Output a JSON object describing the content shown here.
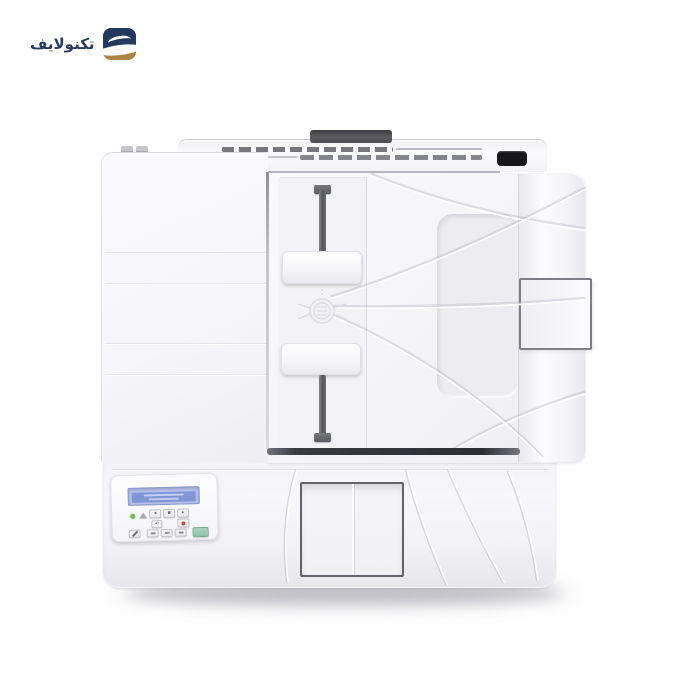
{
  "watermark": {
    "text": "تكنولايف",
    "colors": {
      "navy": "#223a5e",
      "gold": "#ab8444",
      "swoosh": "#ffffff"
    }
  },
  "product_photo": {
    "subject": "white multifunction laser printer, top view",
    "body_color": "#f5f5f8",
    "accent_dark": "#4a4a50",
    "background": "#ffffff"
  },
  "control_panel": {
    "lcd": {
      "bg": "#b3c0e9",
      "band": "#8095d5"
    },
    "indicators": [
      {
        "name": "ready-led",
        "color": "#7db457"
      },
      {
        "name": "attention-triangle",
        "color": "#a7acb3"
      }
    ],
    "buttons": {
      "left_arrow": "◂",
      "ok": "▪",
      "right_arrow": "▸",
      "back": "↶",
      "cancel_dot_color": "#cd4742",
      "copy_green": "#8fc2a9"
    }
  }
}
